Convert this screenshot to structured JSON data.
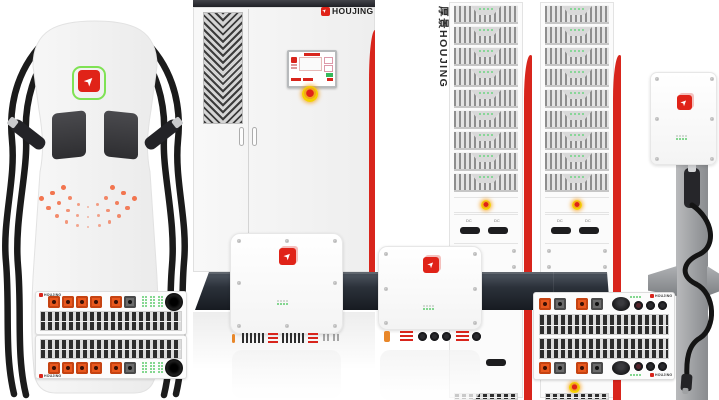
{
  "brand": {
    "name": "HOUJING",
    "vertical_name": "厚景HOUJING",
    "logo_arrow": "➤"
  },
  "rack": {
    "switch_label": "DC",
    "columns": 2,
    "modules_per_column": 9
  },
  "colors": {
    "brand_red": "#e02318",
    "stripe_red": "#d8251c",
    "connector_orange": "#e8571d",
    "indicator_green": "#5ecb6e",
    "station_dot_orange": "#f2683f",
    "estop_yellow": "#f4d000"
  },
  "decor": {
    "station_dot_arcs": [
      {
        "cx": 88,
        "cy": 165,
        "rx": 55,
        "ry": 62,
        "count": 11
      },
      {
        "cx": 88,
        "cy": 165,
        "rx": 42,
        "ry": 52,
        "count": 9
      },
      {
        "cx": 88,
        "cy": 165,
        "rx": 29,
        "ry": 42,
        "count": 7
      }
    ]
  }
}
